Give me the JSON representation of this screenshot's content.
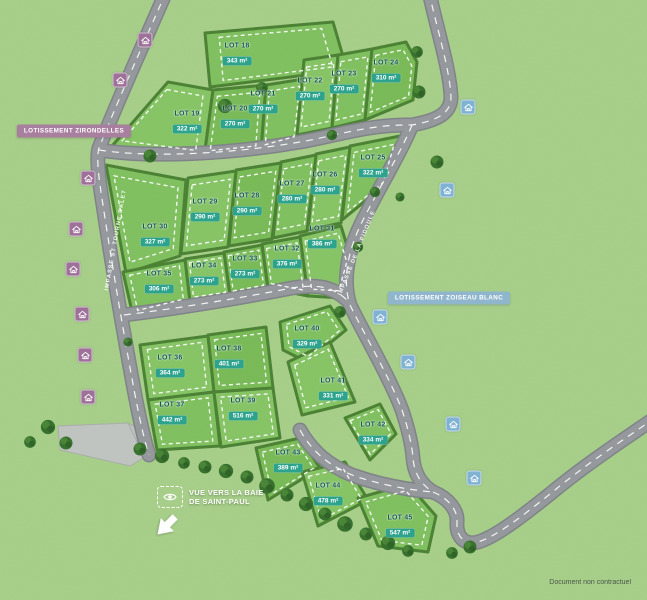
{
  "map": {
    "disclaimer": "Document non contractuel",
    "subdivisions": [
      {
        "label": "LOTISSEMENT ZIRONDELLES",
        "color": "#a97f9f",
        "x": 74,
        "y": 131
      },
      {
        "label": "LOTISSEMENT ZOISEAU BLANC",
        "color": "#8fb6cd",
        "x": 449,
        "y": 298
      }
    ],
    "roads": [
      {
        "name": "IMPASSE ST TOURNE DALET",
        "x": 116,
        "y": 240,
        "angle": -80
      },
      {
        "name": "IMPASSE DE LA PIDOULE",
        "x": 357,
        "y": 253,
        "angle": -68
      }
    ],
    "view_label": {
      "line1": "VUE VERS LA BAIE",
      "line2": "DE SAINT-PAUL"
    },
    "lots": [
      {
        "name": "LOT 18",
        "area": "343 m²",
        "x": 237,
        "y": 55
      },
      {
        "name": "LOT 19",
        "area": "322 m²",
        "x": 187,
        "y": 123
      },
      {
        "name": "LOT 20",
        "area": "270 m²",
        "x": 235,
        "y": 118
      },
      {
        "name": "LOT 21",
        "area": "270 m²",
        "x": 263,
        "y": 103
      },
      {
        "name": "LOT 22",
        "area": "270 m²",
        "x": 310,
        "y": 90
      },
      {
        "name": "LOT 23",
        "area": "270 m²",
        "x": 344,
        "y": 83
      },
      {
        "name": "LOT 24",
        "area": "310 m²",
        "x": 386,
        "y": 72
      },
      {
        "name": "LOT 25",
        "area": "322 m²",
        "x": 373,
        "y": 167
      },
      {
        "name": "LOT 26",
        "area": "280 m²",
        "x": 325,
        "y": 184
      },
      {
        "name": "LOT 27",
        "area": "280 m²",
        "x": 292,
        "y": 193
      },
      {
        "name": "LOT 28",
        "area": "290 m²",
        "x": 247,
        "y": 205
      },
      {
        "name": "LOT 29",
        "area": "290 m²",
        "x": 205,
        "y": 211
      },
      {
        "name": "LOT 30",
        "area": "327 m²",
        "x": 155,
        "y": 236
      },
      {
        "name": "LOT 31",
        "area": "386 m²",
        "x": 322,
        "y": 238
      },
      {
        "name": "LOT 32",
        "area": "376 m²",
        "x": 287,
        "y": 258
      },
      {
        "name": "LOT 33",
        "area": "273 m²",
        "x": 245,
        "y": 268
      },
      {
        "name": "LOT 34",
        "area": "273 m²",
        "x": 204,
        "y": 275
      },
      {
        "name": "LOT 35",
        "area": "306 m²",
        "x": 159,
        "y": 283
      },
      {
        "name": "LOT 36",
        "area": "364 m²",
        "x": 170,
        "y": 367
      },
      {
        "name": "LOT 37",
        "area": "442 m²",
        "x": 172,
        "y": 414
      },
      {
        "name": "LOT 38",
        "area": "401 m²",
        "x": 229,
        "y": 358
      },
      {
        "name": "LOT 39",
        "area": "516 m²",
        "x": 243,
        "y": 410
      },
      {
        "name": "LOT 40",
        "area": "329 m²",
        "x": 307,
        "y": 338
      },
      {
        "name": "LOT 41",
        "area": "331 m²",
        "x": 333,
        "y": 390
      },
      {
        "name": "LOT 42",
        "area": "334 m²",
        "x": 373,
        "y": 434
      },
      {
        "name": "LOT 43",
        "area": "389 m²",
        "x": 288,
        "y": 462
      },
      {
        "name": "LOT 44",
        "area": "478 m²",
        "x": 328,
        "y": 495
      },
      {
        "name": "LOT 45",
        "area": "547 m²",
        "x": 400,
        "y": 527
      }
    ],
    "house_icons": [
      {
        "type": "purple",
        "x": 145,
        "y": 40
      },
      {
        "type": "purple",
        "x": 120,
        "y": 80
      },
      {
        "type": "purple",
        "x": 88,
        "y": 178
      },
      {
        "type": "purple",
        "x": 76,
        "y": 229
      },
      {
        "type": "purple",
        "x": 73,
        "y": 269
      },
      {
        "type": "purple",
        "x": 82,
        "y": 314
      },
      {
        "type": "purple",
        "x": 85,
        "y": 355
      },
      {
        "type": "purple",
        "x": 88,
        "y": 397
      },
      {
        "type": "blue",
        "x": 468,
        "y": 107
      },
      {
        "type": "blue",
        "x": 447,
        "y": 190
      },
      {
        "type": "blue",
        "x": 380,
        "y": 317
      },
      {
        "type": "blue",
        "x": 408,
        "y": 362
      },
      {
        "type": "blue",
        "x": 453,
        "y": 424
      },
      {
        "type": "blue",
        "x": 474,
        "y": 478
      }
    ],
    "colors": {
      "grass": "#a6cf88",
      "lot_green": "#7fc05e",
      "hedge": "#4a8132",
      "road": "#94979b",
      "area_badge": "#2da28c",
      "lot_text": "#0d564c",
      "purple_icon": "#9d7198",
      "blue_icon": "#7fb2d3",
      "badge_zirondelles": "#a97f9f",
      "badge_zoiseau": "#8fb6cd"
    }
  }
}
